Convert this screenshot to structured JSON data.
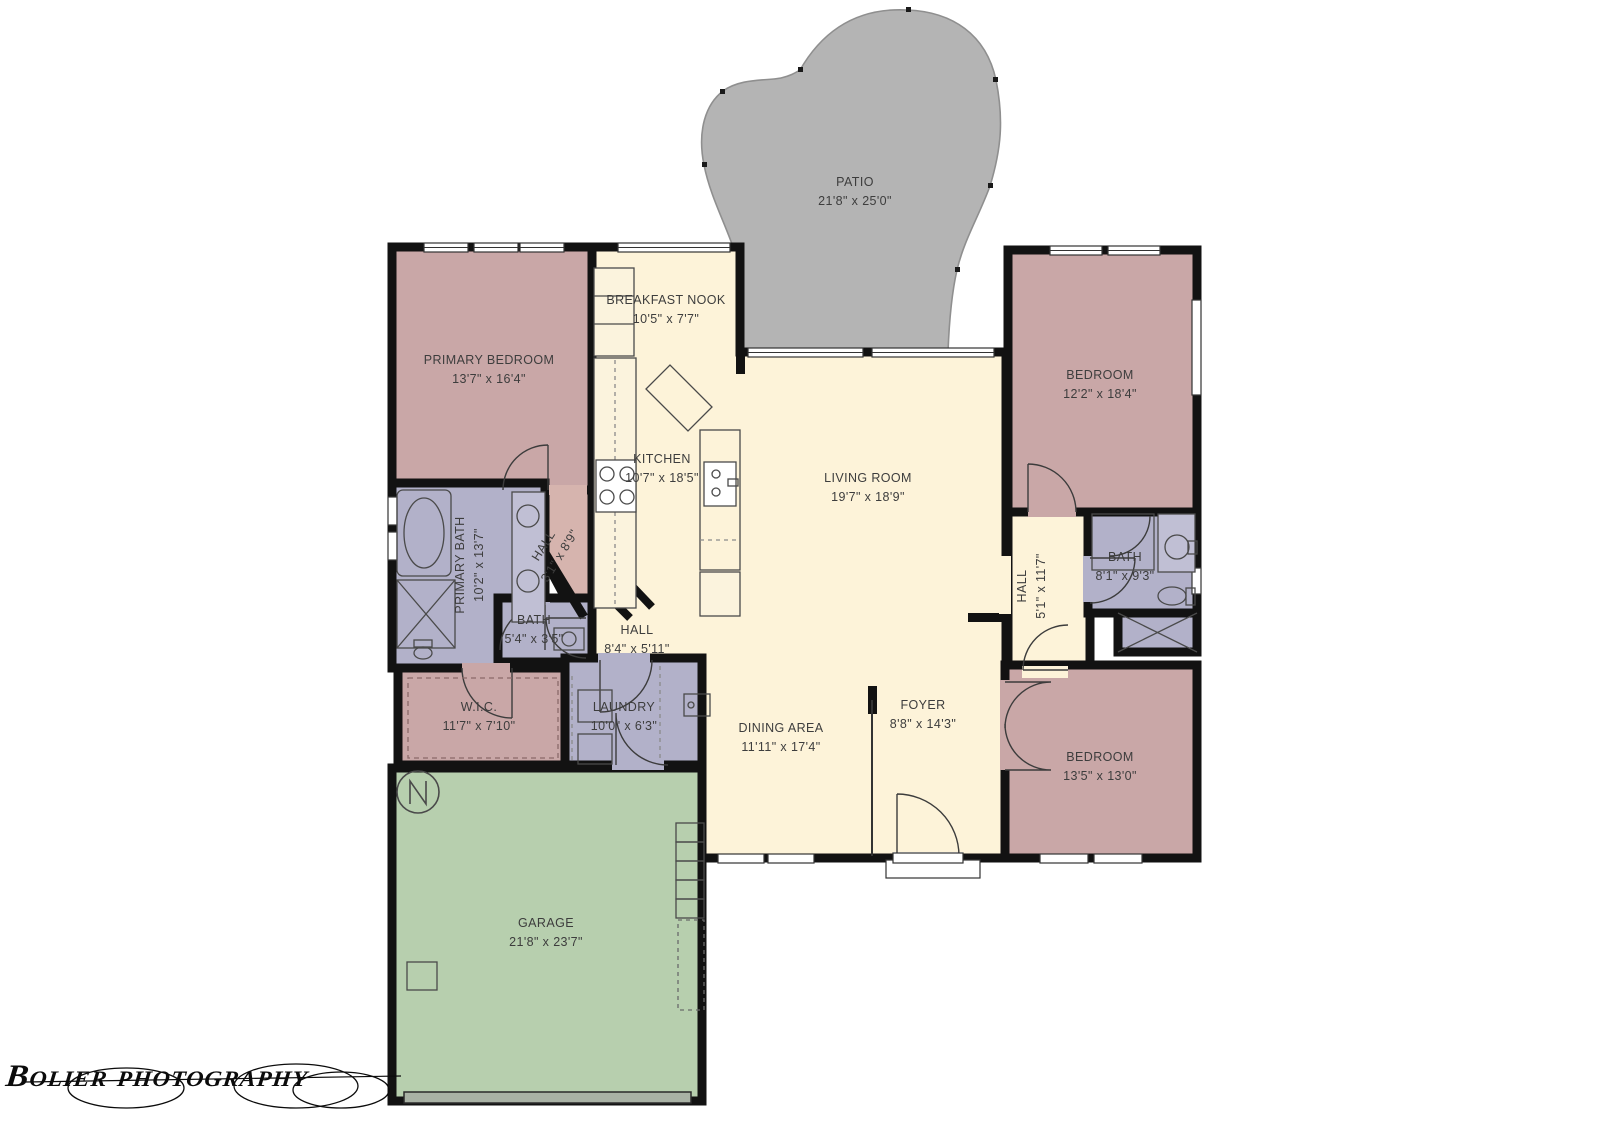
{
  "watermark": {
    "text": "Bolier photography"
  },
  "colors": {
    "bedroom": "#c9a7a7",
    "open": "#fdf3d9",
    "bath": "#b2b1c9",
    "garage": "#b7cfae",
    "patio": "#b4b4b4",
    "halldiag": "#d6b4ae",
    "wall": "#121212",
    "label": "#3d3d3d",
    "fixture": "#555555"
  },
  "rooms": [
    {
      "id": "patio",
      "name": "PATIO",
      "dims": "21'8\" x 25'0\""
    },
    {
      "id": "primary-bedroom",
      "name": "PRIMARY BEDROOM",
      "dims": "13'7\" x 16'4\""
    },
    {
      "id": "breakfast-nook",
      "name": "BREAKFAST NOOK",
      "dims": "10'5\" x 7'7\""
    },
    {
      "id": "kitchen",
      "name": "KITCHEN",
      "dims": "10'7\" x 18'5\""
    },
    {
      "id": "living-room",
      "name": "LIVING ROOM",
      "dims": "19'7\" x 18'9\""
    },
    {
      "id": "bedroom-tr",
      "name": "BEDROOM",
      "dims": "12'2\" x 18'4\""
    },
    {
      "id": "primary-bath",
      "name": "PRIMARY BATH",
      "dims": "10'2\" x 13'7\""
    },
    {
      "id": "hall-diagonal",
      "name": "HALL",
      "dims": "3'1\" x 8'9\""
    },
    {
      "id": "bath-small",
      "name": "BATH",
      "dims": "5'4\" x 3'5\""
    },
    {
      "id": "hall-center",
      "name": "HALL",
      "dims": "8'4\" x 5'11\""
    },
    {
      "id": "wic",
      "name": "W.I.C.",
      "dims": "11'7\" x 7'10\""
    },
    {
      "id": "laundry",
      "name": "LAUNDRY",
      "dims": "10'0\" x 6'3\""
    },
    {
      "id": "dining-area",
      "name": "DINING AREA",
      "dims": "11'11\" x 17'4\""
    },
    {
      "id": "foyer",
      "name": "FOYER",
      "dims": "8'8\" x 14'3\""
    },
    {
      "id": "hall-right",
      "name": "HALL",
      "dims": "5'1\" x 11'7\""
    },
    {
      "id": "bath-right",
      "name": "BATH",
      "dims": "8'1\" x 9'3\""
    },
    {
      "id": "bedroom-br",
      "name": "BEDROOM",
      "dims": "13'5\" x 13'0\""
    },
    {
      "id": "garage",
      "name": "GARAGE",
      "dims": "21'8\" x 23'7\""
    }
  ]
}
